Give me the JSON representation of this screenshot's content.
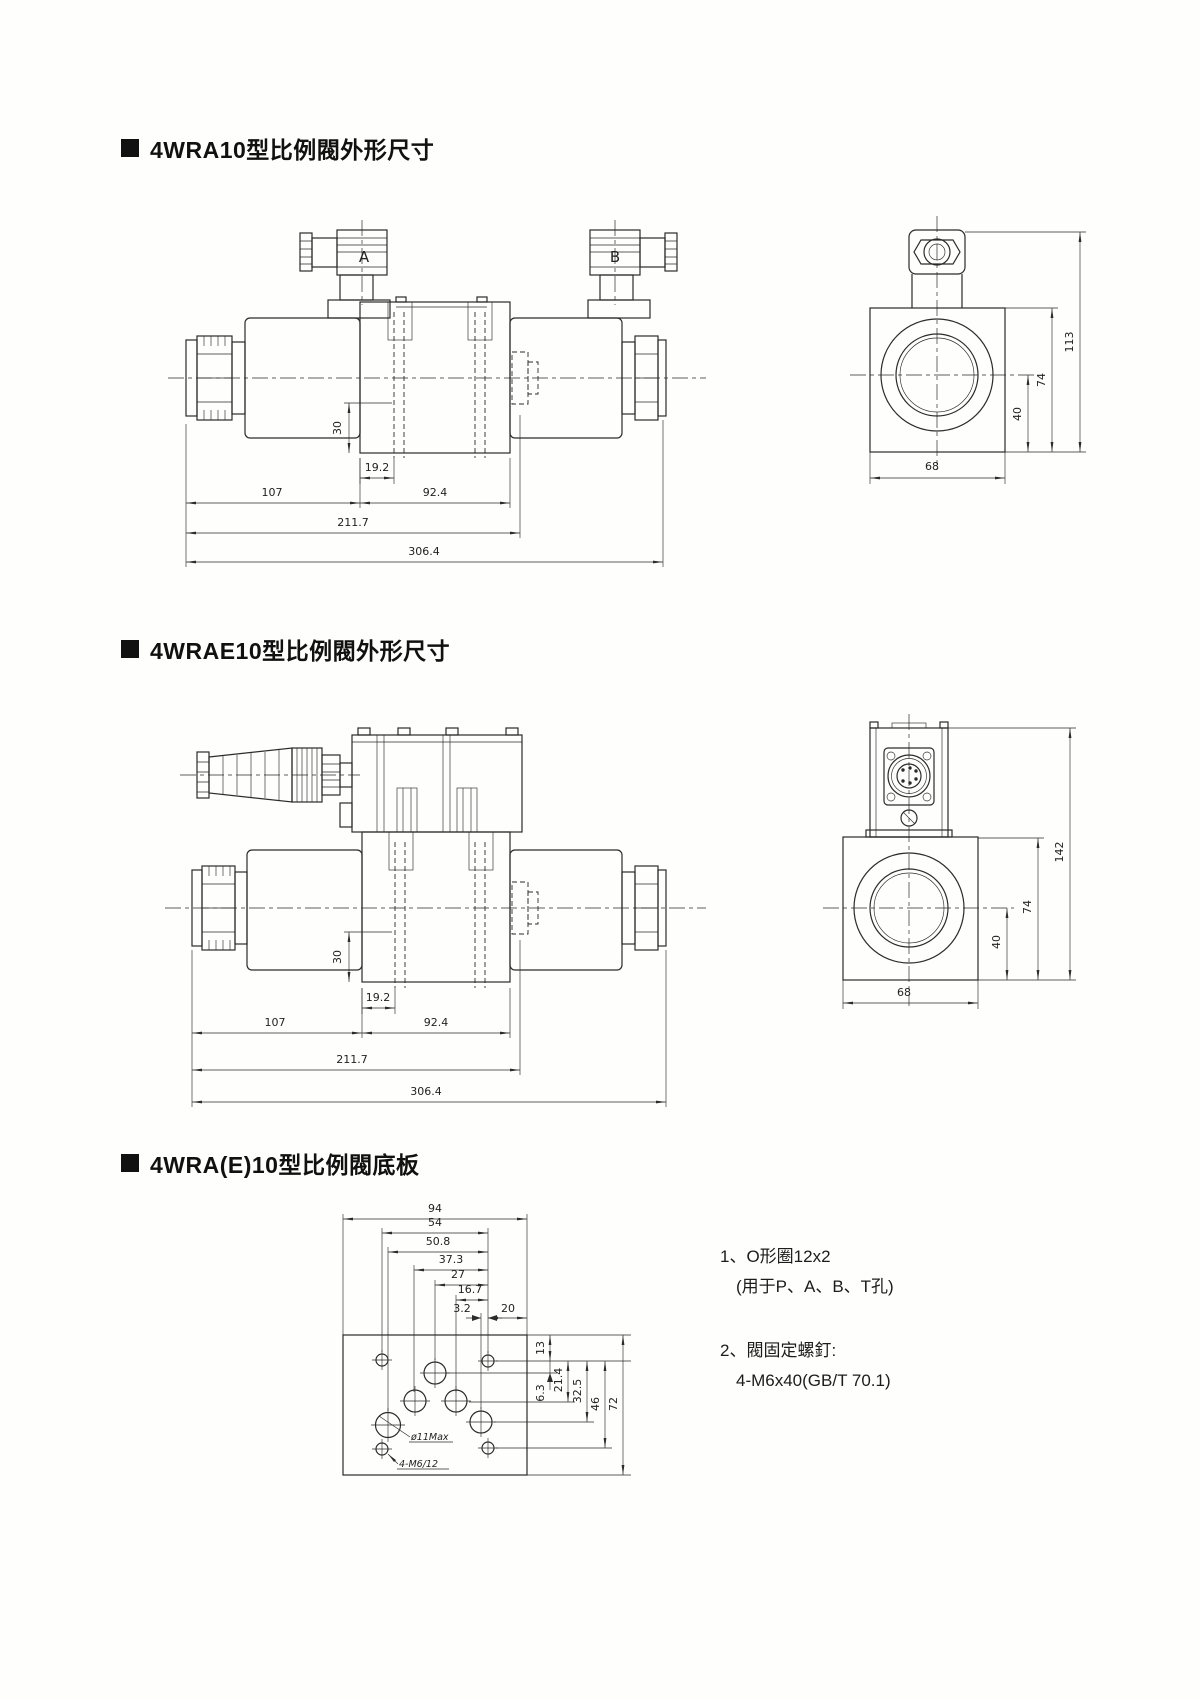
{
  "page": {
    "background": "#fefefc",
    "ink_color": "#2b2b2b"
  },
  "sections": [
    {
      "title": "4WRA10型比例閥外形尺寸"
    },
    {
      "title": "4WRAE10型比例閥外形尺寸"
    },
    {
      "title": "4WRA(E)10型比例閥底板"
    }
  ],
  "valve1": {
    "solenoid_a_label": "A",
    "solenoid_b_label": "B",
    "dims": {
      "d30": "30",
      "d19_2": "19.2",
      "d107": "107",
      "d92_4": "92.4",
      "d211_7": "211.7",
      "d306_4": "306.4"
    },
    "side": {
      "d113": "113",
      "d74": "74",
      "d40": "40",
      "d68": "68"
    }
  },
  "valve2": {
    "dims": {
      "d30": "30",
      "d19_2": "19.2",
      "d107": "107",
      "d92_4": "92.4",
      "d211_7": "211.7",
      "d306_4": "306.4"
    },
    "side": {
      "d142": "142",
      "d74": "74",
      "d40": "40",
      "d68": "68"
    }
  },
  "subplate": {
    "dims_top": {
      "d94": "94",
      "d54": "54",
      "d50_8": "50.8",
      "d37_3": "37.3",
      "d27": "27",
      "d16_7": "16.7",
      "d3_2": "3.2",
      "d20": "20"
    },
    "dims_right": {
      "d13": "13",
      "d6_3": "6.3",
      "d21_4": "21.4",
      "d32_5": "32.5",
      "d46": "46",
      "d72": "72"
    },
    "labels": {
      "port_diameter": "ø11Max",
      "mount_holes": "4-M6/12"
    },
    "notes": [
      {
        "line1": "1、O形圈12x2",
        "line2": "(用于P、A、B、T孔)"
      },
      {
        "line1": "2、閥固定螺釘:",
        "line2": "4-M6x40(GB/T 70.1)"
      }
    ]
  }
}
